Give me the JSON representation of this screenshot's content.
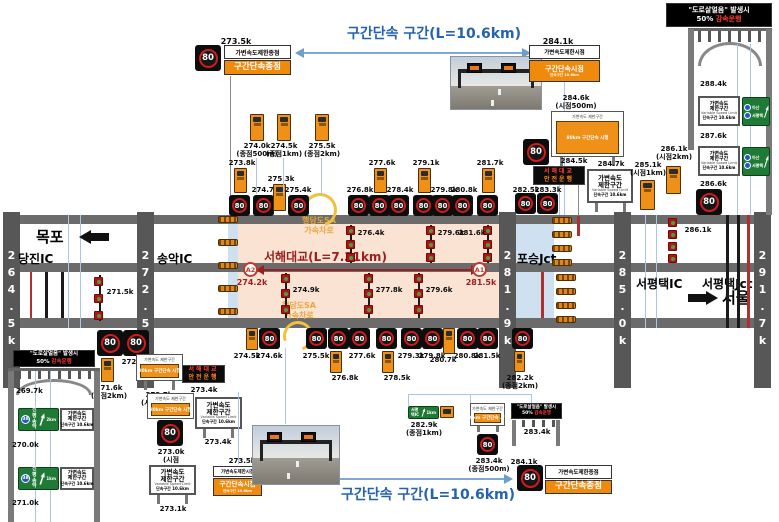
{
  "spd": "80",
  "colors": {
    "accent_blue": "#2563ae",
    "sign_orange": "#ef8a0d",
    "bridge_peach": "#fae3d3",
    "zone_blue": "#cfe0f0",
    "bar_gray": "#575757",
    "dark_red": "#9a2020",
    "led_red": "#ff4136",
    "led_orange": "#ff851b",
    "sign_green": "#1f7a36"
  },
  "section": {
    "top": "구간단속 구간(L=10.6km)",
    "bottom": "구간단속 구간(L=10.6km)"
  },
  "ice": {
    "line1": "\"도로살얼음\" 발생시",
    "l2a": "50%",
    "l2b": "감속운행"
  },
  "led": {
    "l1": "서해대교",
    "l2": "안전운행"
  },
  "vsl": {
    "l1": "가변속도\n제한구간",
    "l2": "Variable Speed Limit",
    "l3": "단속구간 10.6km"
  },
  "combo": {
    "head": "가변속도 제한구간",
    "body": "80km 구간단속 시행"
  },
  "start_sign": {
    "white": "가변속도제한시점",
    "o1": "구간단속시점",
    "o2": "단속구간 10.6km"
  },
  "end_sign": {
    "white": "가변속도제한종점",
    "o1": "구간단속종점"
  },
  "bars": [
    "264.5k",
    "272.5k",
    "281.9k",
    "285.0k",
    "291.7k"
  ],
  "road": {
    "mokpo": "목포",
    "dangjin": "당진IC",
    "songak": "송악IC",
    "poseung": "포승Jct",
    "sp_ic": "서평택IC",
    "sp_jct": "서평택Jct",
    "seoul": "서울"
  },
  "bridge": {
    "title": "서해대교(L=7.31km)",
    "a2": "A2",
    "a2_km": "274.2k",
    "a1": "A1",
    "a1_km": "281.5k",
    "sa_top": "행담도SA\n가속차로",
    "sa_bottom": "행담도SA\n가속차로"
  },
  "top_left": {
    "km": "273.5k"
  },
  "top_right": {
    "km": "284.1k",
    "km2": "284.6k\n(시점500m)"
  },
  "row_above": [
    "273.8k",
    "274.7k",
    "275.3k",
    "275.4k",
    "276.8k",
    "277.6k",
    "278.4k",
    "279.1k",
    "279.8k",
    "280.8k",
    "281.7k"
  ],
  "grp_above": [
    "274.0k\n(종점500m)",
    "274.5k\n(종점1km)",
    "275.5k\n(종점2km)"
  ],
  "right_above": {
    "k1": "282.5k",
    "k2": "283.3k",
    "k3": "284.5k",
    "k4": "284.7k",
    "k5": "285.1k\n(시점1km)",
    "k6": "286.1k\n(시점2km)"
  },
  "right_road": {
    "k1": "288.4k",
    "k2": "287.6k",
    "k3": "286.6k"
  },
  "in_road": {
    "k271_5": "271.5k",
    "up": [
      "276.4k",
      "279.6k",
      "281.6k"
    ],
    "low": [
      "274.9k",
      "277.8k",
      "279.6k"
    ],
    "k286_1": "286.1k"
  },
  "row_below": [
    "274.5k",
    "274.6k",
    "275.5k",
    "276.8k",
    "277.6k",
    "278.5k",
    "279.3k",
    "279.8k",
    "280.7k",
    "280.8k",
    "281.5k"
  ],
  "below_right": {
    "k282_2": "282.2k\n(종점2km)",
    "k282_9": "282.9k\n(종점1km)",
    "k283_4a": "283.4k\n(종점500m)",
    "k283_4b": "283.4k",
    "k284_1": "284.1k"
  },
  "below_left": {
    "k271_6": "271.6k\n(시점2km)",
    "k272_4": "272.4k"
  },
  "left_cluster": {
    "k272_7": "272.7k\n(시점1km)",
    "k273_4a": "273.4k",
    "k273_4b": "273.4k",
    "k273_0": "273.0k\n(시점500m)",
    "k273_1": "273.1k",
    "k273_5": "273.5k"
  },
  "left_road": {
    "k269_7": "269.7k",
    "k270_0": "270.0k",
    "k271_0": "271.0k"
  },
  "green_ramp": {
    "badge": "38",
    "name": "신평\n송악",
    "d1": "2km",
    "d2": "1km"
  },
  "green_exit": {
    "n1": "아산",
    "n2": "서평택",
    "dist": "2km"
  },
  "green_exit_small": {
    "name": "서평택IC",
    "dist": "1km"
  }
}
